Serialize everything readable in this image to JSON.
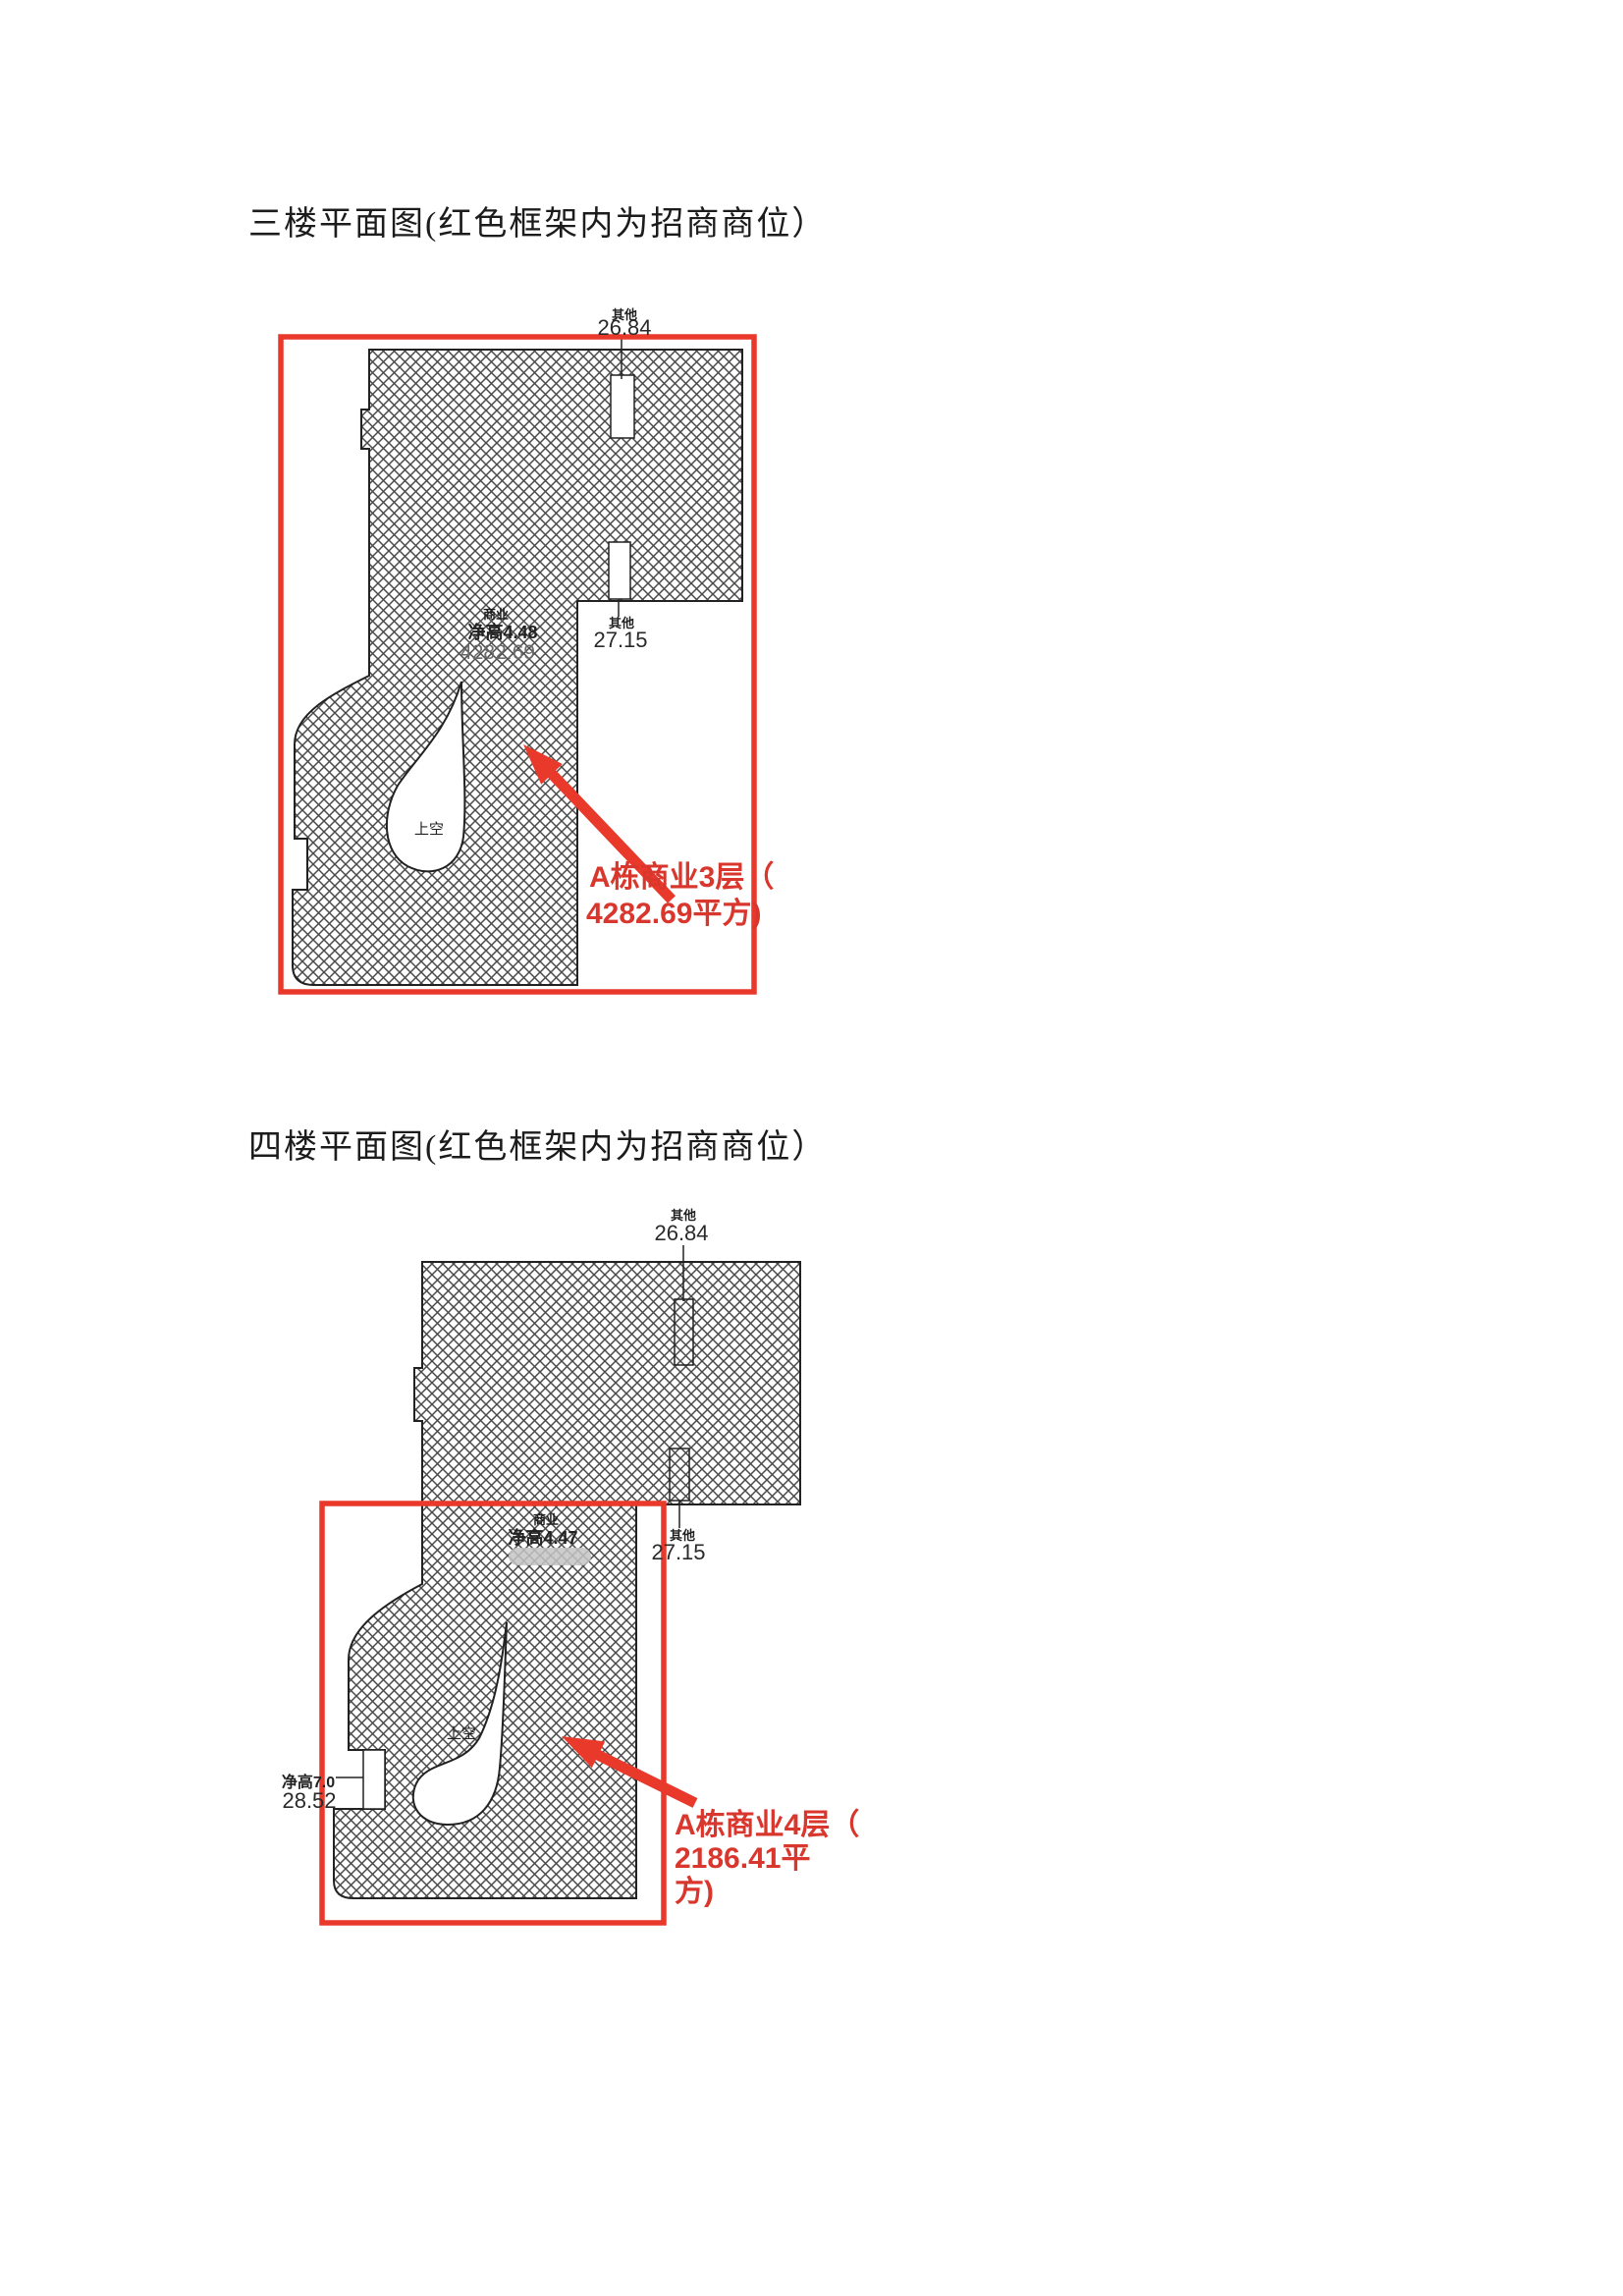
{
  "colors": {
    "red_frame": "#e8392b",
    "red_text": "#d9372d",
    "outline": "#222222",
    "hatch_line": "#4a4a4a",
    "redact_gray": "#c4c4c4"
  },
  "floor3": {
    "title": "三楼平面图(红色框架内为招商商位）",
    "labels": {
      "top": {
        "category": "其他",
        "value": "26.84"
      },
      "mid": {
        "category": "其他",
        "value": "27.15"
      },
      "unit": {
        "type": "商业",
        "height": "净高4.48",
        "area": "4282.69"
      },
      "void": "上空"
    },
    "callout": {
      "line1": "A栋商业3层（",
      "line2": "4282.69平方)"
    }
  },
  "floor4": {
    "title": "四楼平面图(红色框架内为招商商位）",
    "labels": {
      "top": {
        "category": "其他",
        "value": "26.84"
      },
      "mid": {
        "category": "其他",
        "value": "27.15"
      },
      "unit": {
        "type": "商业",
        "height": "净高4.47"
      },
      "left": {
        "height": "净高7.0",
        "value": "28.52"
      },
      "void": "上空"
    },
    "callout": {
      "line1": "A栋商业4层（",
      "line2": "2186.41平",
      "line3": "方)"
    }
  }
}
